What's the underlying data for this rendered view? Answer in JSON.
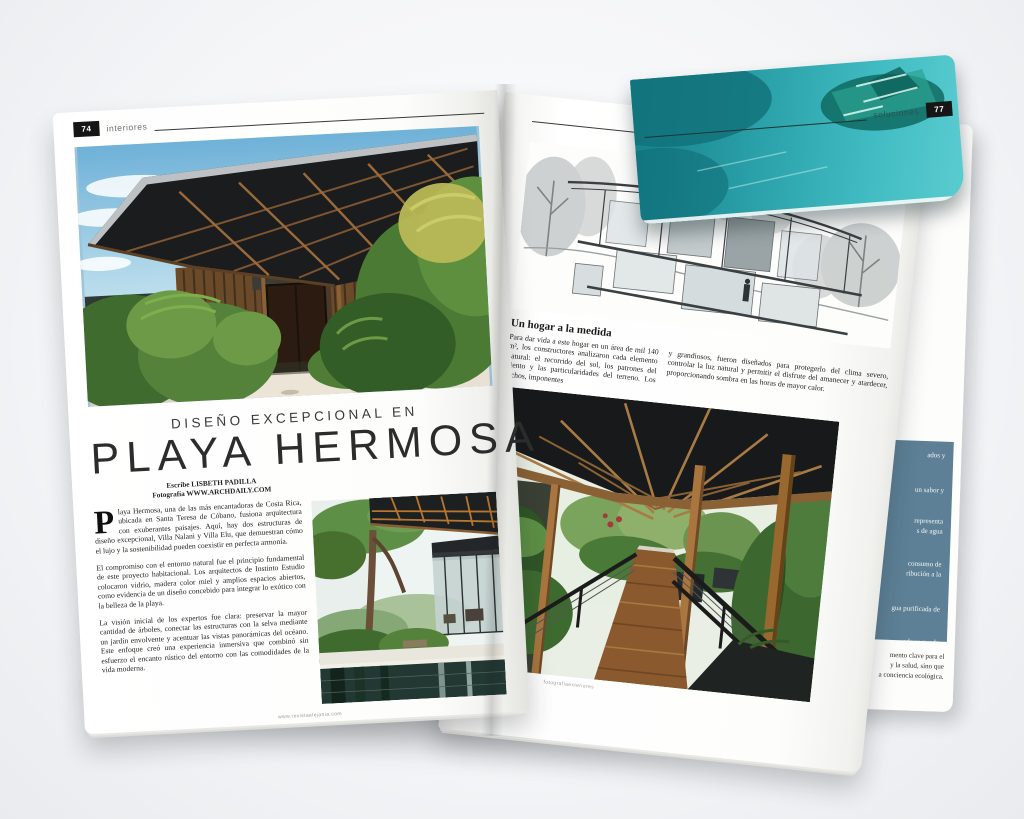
{
  "magazine": {
    "left_page": {
      "header": {
        "page_number": "74",
        "section": "interiores"
      },
      "kicker": "DISEÑO EXCEPCIONAL EN",
      "title": "PLAYA HERMOSA",
      "byline_author": "Escribe LISBETH PADILLA",
      "byline_photo": "Fotografía WWW.ARCHDAILY.COM",
      "dropcap": "P",
      "paragraph_1": "laya Hermosa, una de las más encantadoras de Costa Rica, ubicada en Santa Teresa de Cóbano, fusiona arquitectura con exuberantes paisajes. Aquí, hay dos estructuras de diseño excepcional, Villa Nalani y Villa Elu, que demuestran cómo el lujo y la sostenibilidad pueden coexistir en perfecta armonía.",
      "paragraph_2": "El compromiso con el entorno natural fue el principio fundamental de este proyecto habitacional. Los arquitectos de Instinto Estudio colocaron vidrio, madera color miel y amplios espacios abiertos, como evidencia de un diseño concebido para integrar lo exótico con la belleza de la playa.",
      "paragraph_3": "La visión inicial de los expertos fue clara: preservar la mayor cantidad de árboles, conectar las estructuras con la selva mediante un jardín envolvente y acentuar las vistas panorámicas del océano. Este enfoque creó una experiencia inmersiva que combinó sin esfuerzo el encanto rústico del entorno con las comodidades de la vida moderna.",
      "footer_url": "www.revistaelejania.com"
    },
    "right_page": {
      "header": {
        "section": "interiores",
        "page_number": "75"
      },
      "heading": "Un hogar a la medida",
      "column_1": "Para dar vida a este hogar en un área de mil 140 m², los constructores analizaron cada elemento natural: el recorrido del sol, los patrones del viento y las particularidades del terreno. Los techos, imponentes",
      "column_2": "y grandiosos, fueron diseñados para protegerlo del clima severo, controlar la luz natural y permitir el disfrute del amanecer y atardecer, proporcionando sombra en las horas de mayor calor.",
      "footer_credit": "fotografiaexteriores"
    },
    "back_page": {
      "header": {
        "section": "soluciones",
        "page_number": "77"
      },
      "sidebar_fragments": [
        "ados y",
        "un sabor y",
        "representa",
        "s de agua",
        "consumo de",
        "ribución a la",
        "gua purificada de",
        "ada se puede",
        "laborar bebidas y"
      ],
      "bottom_fragments": [
        "mento clave para el",
        "y la salud, sino que",
        "a conciencia ecológica."
      ]
    },
    "colors": {
      "teal": "#2aa0a8",
      "slate_blue": "#5d8096",
      "header_black": "#161616"
    }
  }
}
